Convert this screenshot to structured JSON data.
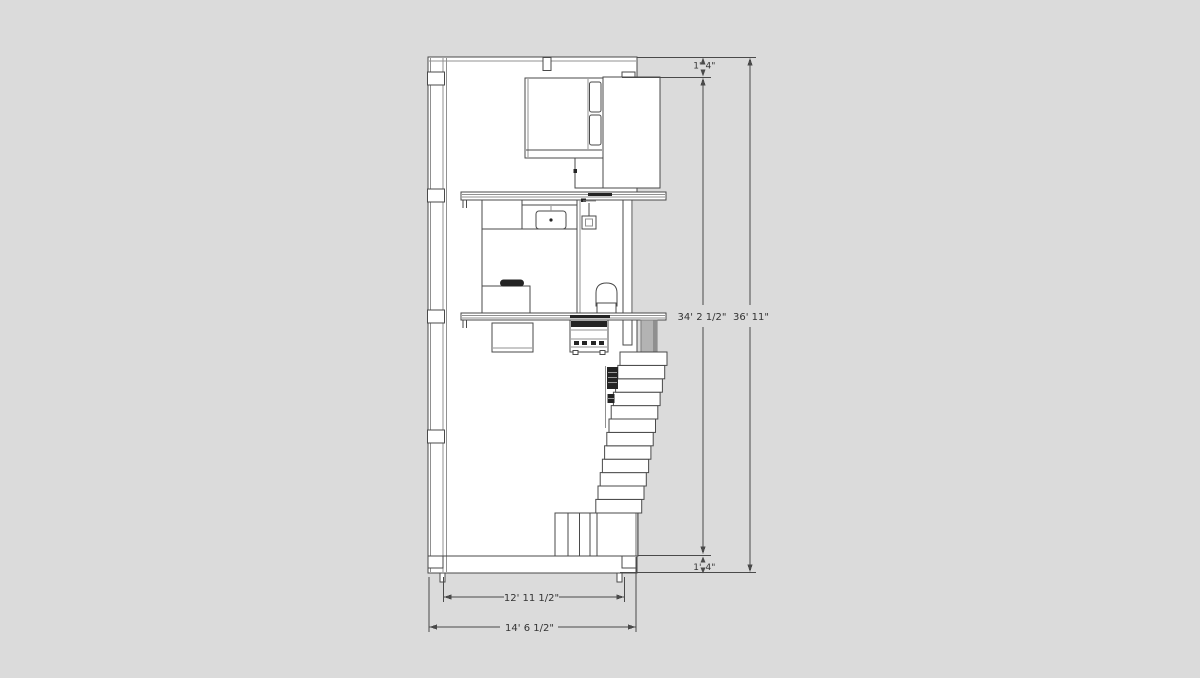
{
  "colors": {
    "background": "#dbdbdb",
    "paper": "#ffffff",
    "line": "#4a4a4a",
    "line-light": "#909090",
    "dark": "#242424",
    "column": "#b3b3b3",
    "column-dark": "#8f8f8f",
    "text": "#333333"
  },
  "dimensions": {
    "overall_height": "36' 11\"",
    "interior_height": "34' 2 1/2\"",
    "top_offset_feet": "1'",
    "top_offset_inches": "4\"",
    "bottom_offset_feet": "1'",
    "bottom_offset_inches": "4\"",
    "interior_width": "12' 11 1/2\"",
    "overall_width": "14' 6 1/2\""
  }
}
